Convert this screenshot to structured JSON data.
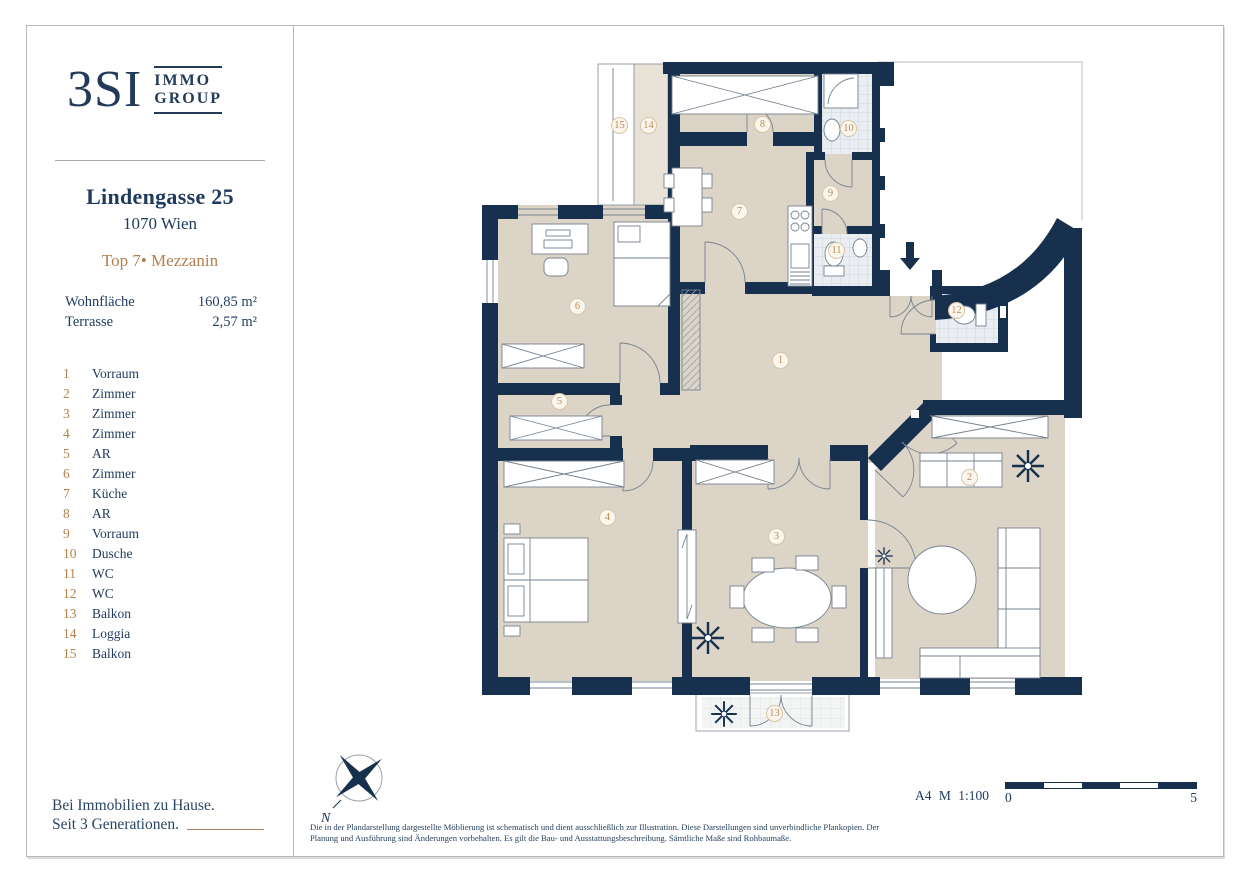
{
  "brand": {
    "logo_main": "3SI",
    "logo_sub_top": "IMMO",
    "logo_sub_bottom": "GROUP",
    "tagline_line1": "Bei Immobilien zu Hause.",
    "tagline_line2": "Seit 3 Generationen."
  },
  "property": {
    "street": "Lindengasse 25",
    "city": "1070 Wien",
    "unit": "Top 7• Mezzanin",
    "areas": [
      {
        "label": "Wohnfläche",
        "value": "160,85 m²"
      },
      {
        "label": "Terrasse",
        "value": "2,57 m²"
      }
    ]
  },
  "legend": {
    "items": [
      {
        "num": "1",
        "label": "Vorraum"
      },
      {
        "num": "2",
        "label": "Zimmer"
      },
      {
        "num": "3",
        "label": "Zimmer"
      },
      {
        "num": "4",
        "label": "Zimmer"
      },
      {
        "num": "5",
        "label": "AR"
      },
      {
        "num": "6",
        "label": "Zimmer"
      },
      {
        "num": "7",
        "label": "Küche"
      },
      {
        "num": "8",
        "label": "AR"
      },
      {
        "num": "9",
        "label": "Vorraum"
      },
      {
        "num": "10",
        "label": "Dusche"
      },
      {
        "num": "11",
        "label": "WC"
      },
      {
        "num": "12",
        "label": "WC"
      },
      {
        "num": "13",
        "label": "Balkon"
      },
      {
        "num": "14",
        "label": "Loggia"
      },
      {
        "num": "15",
        "label": "Balkon"
      }
    ]
  },
  "plan": {
    "compass_label": "N"
  },
  "footer": {
    "scale_note": "A4 M 1:100",
    "scale_start": "0",
    "scale_end": "5",
    "disclaimer": "Die in der Plandarstellung dargestellte Möblierung ist schematisch und dient ausschließlich zur Illustration. Diese Darstellungen sind unverbindliche Plankopien. Der Planung und Ausführung sind Änderungen vorbehalten. Es gilt die Bau- und Ausstattungsbeschreibung. Sämtliche Maße sind Rohbaumaße."
  },
  "colors": {
    "wall_navy": "#16304e",
    "floor_beige": "#dcd4c7",
    "tile_blue": "#eaeef3",
    "accent_gold": "#b3814f",
    "text_navy": "#1e3a5c"
  }
}
